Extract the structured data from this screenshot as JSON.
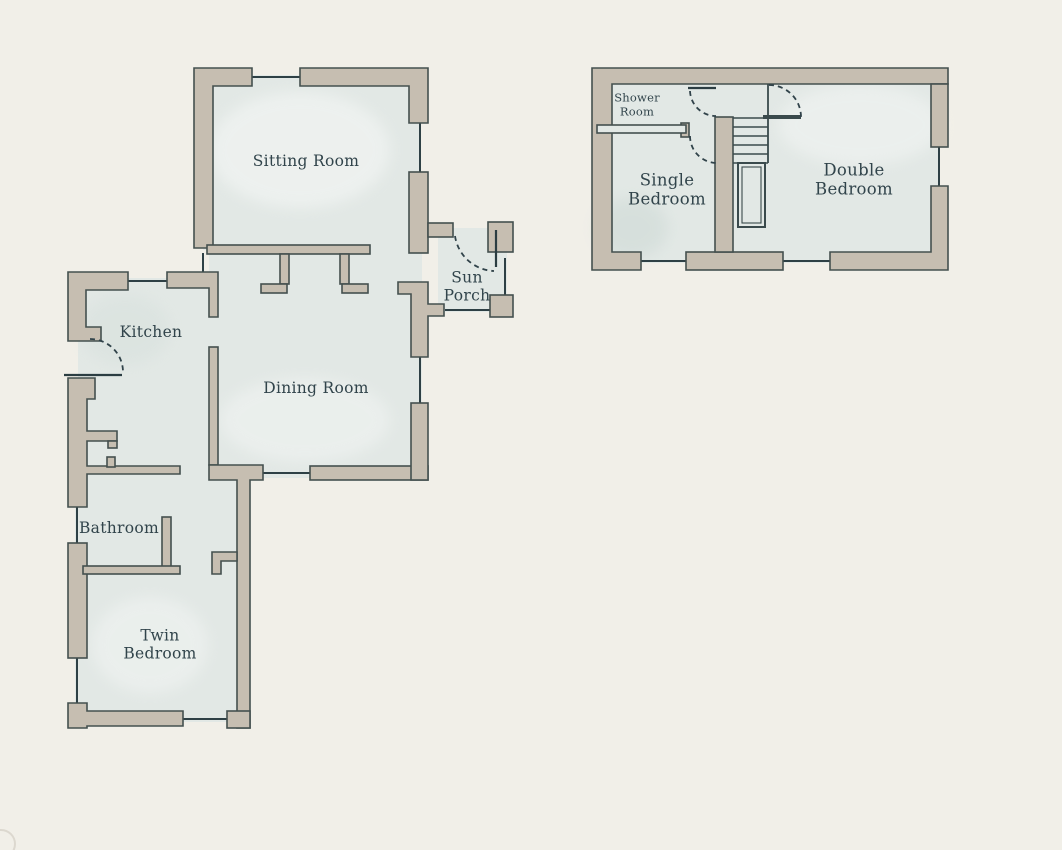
{
  "plan_title": "Two-storey cottage floor plan",
  "rooms": {
    "sitting": {
      "label": "Sitting Room"
    },
    "sun_porch": {
      "label": "Sun Porch"
    },
    "kitchen": {
      "label": "Kitchen"
    },
    "dining": {
      "label": "Dining Room"
    },
    "bathroom": {
      "label": "Bathroom"
    },
    "twin": {
      "label": "Twin Bedroom"
    },
    "shower": {
      "label": "Shower Room"
    },
    "single": {
      "label": "Single Bedroom"
    },
    "double": {
      "label": "Double Bedroom"
    }
  },
  "colors": {
    "background": "#f1efe8",
    "room_fill": "#e2e8e5",
    "wall_fill": "#c6beb1",
    "wall_outline": "#44504f",
    "window_line": "#2e4045",
    "door_dash": "#31434a",
    "label_text": "#31444b"
  }
}
